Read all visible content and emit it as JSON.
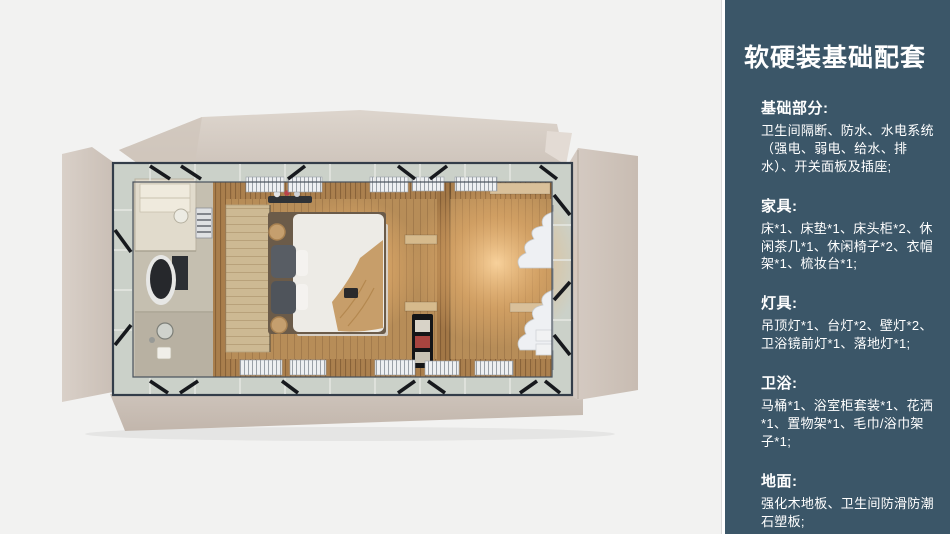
{
  "sidebar": {
    "title": "软硬装基础配套",
    "sections": [
      {
        "heading": "基础部分:",
        "body": "卫生间隔断、防水、水电系统（强电、弱电、给水、排水）、开关面板及插座;"
      },
      {
        "heading": "家具:",
        "body": "床*1、床垫*1、床头柜*2、休闲茶几*1、休闲椅子*2、衣帽架*1、梳妆台*1;"
      },
      {
        "heading": "灯具:",
        "body": "吊顶灯*1、台灯*2、壁灯*2、卫浴镜前灯*1、落地灯*1;"
      },
      {
        "heading": "卫浴:",
        "body": "马桶*1、浴室柜套装*1、花洒*1、置物架*1、毛巾/浴巾架子*1;"
      },
      {
        "heading": "地面:",
        "body": "强化木地板、卫生间防滑防潮石塑板;"
      }
    ]
  },
  "colors": {
    "sidebar_bg": "#3b5668",
    "sidebar_text": "#ffffff",
    "page_bg": "#f2f2f1",
    "panel_beige": "#d7cec6",
    "panel_beige_dark": "#c7bcb3",
    "frame_dark": "#333d49",
    "band_gray_green": "#cbd1c9",
    "wood_floor": "#b78d58",
    "wood_wall": "#a97e4c",
    "warm_glow": "#ffd9a3",
    "bed_duvet": "#edebe6",
    "brace_black": "#17191d"
  }
}
